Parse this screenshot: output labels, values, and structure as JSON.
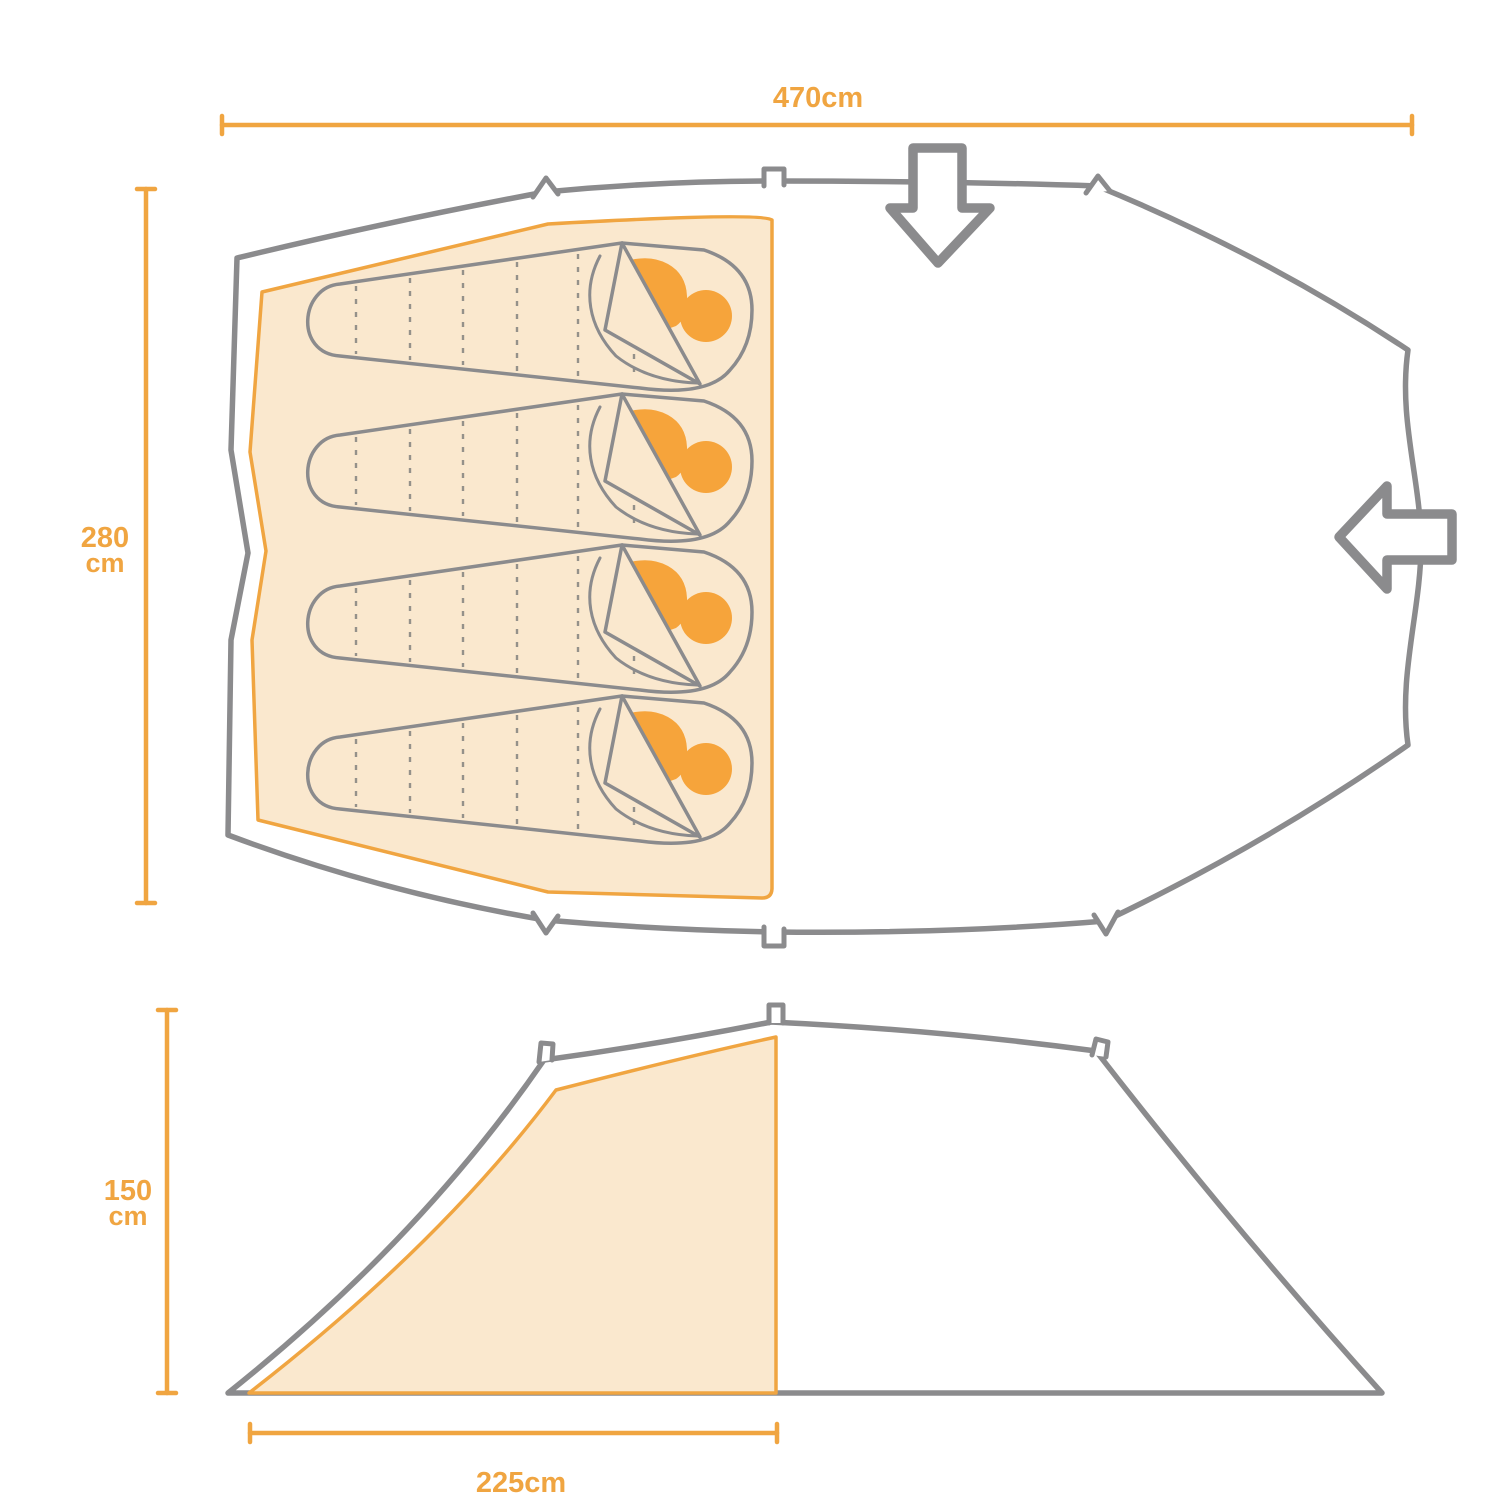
{
  "diagram": {
    "top_view": {
      "width_label": "470cm",
      "depth_label_value": "280",
      "depth_label_unit": "cm"
    },
    "side_view": {
      "height_label_value": "150",
      "height_label_unit": "cm",
      "sleeping_area_width_label": "225cm"
    },
    "sleeping_bag_count": 4
  },
  "icons": {
    "down_arrow": "entrance-arrow-down",
    "left_arrow": "entrance-arrow-left"
  },
  "colors": {
    "accent_orange": "#F0A541",
    "fill_cream": "#FAE8CE",
    "pillow_orange": "#F6A43B",
    "outline_gray": "#8B8B8D",
    "dash_gray": "#94918A"
  }
}
